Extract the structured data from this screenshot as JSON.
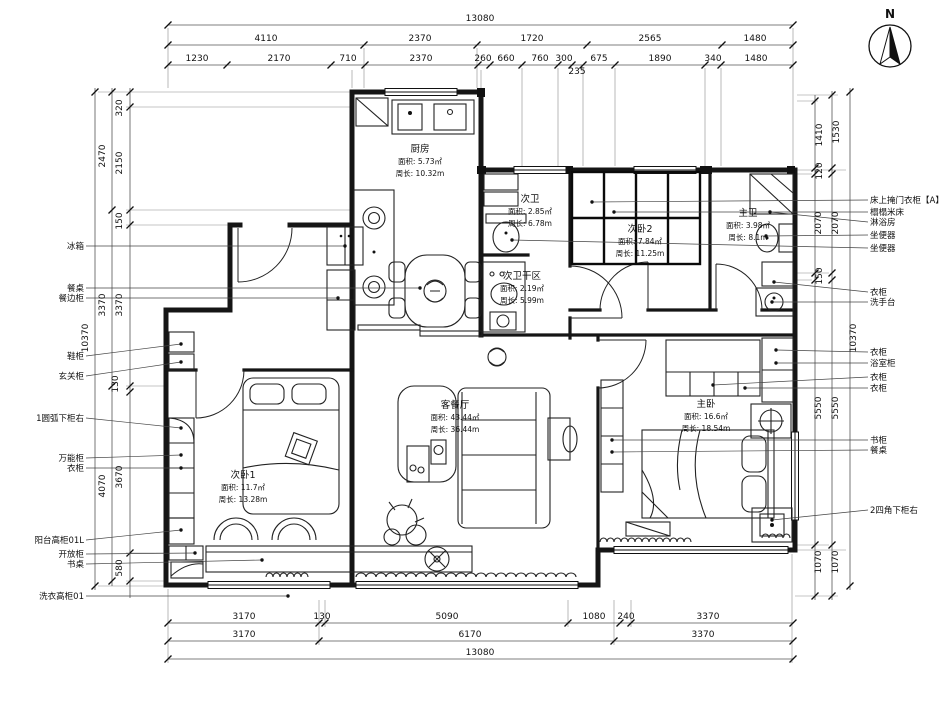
{
  "compass": {
    "label": "N"
  },
  "rooms": [
    {
      "name": "厨房",
      "area": "面积: 5.73㎡",
      "perim": "周长: 10.32m",
      "x": 420,
      "y": 152
    },
    {
      "name": "次卫",
      "area": "面积: 2.85㎡",
      "perim": "周长: 6.78m",
      "x": 530,
      "y": 202
    },
    {
      "name": "次卧2",
      "area": "面积: 7.84㎡",
      "perim": "周长: 11.25m",
      "x": 640,
      "y": 232
    },
    {
      "name": "次卫干区",
      "area": "面积: 2.19㎡",
      "perim": "周长: 5.99m",
      "x": 522,
      "y": 279
    },
    {
      "name": "主卫",
      "area": "面积: 3.98㎡",
      "perim": "周长: 8.1m",
      "x": 748,
      "y": 216
    },
    {
      "name": "客餐厅",
      "area": "面积: 43.44㎡",
      "perim": "周长: 36.44m",
      "x": 455,
      "y": 408
    },
    {
      "name": "主卧",
      "area": "面积: 16.6㎡",
      "perim": "周长: 18.54m",
      "x": 706,
      "y": 407
    },
    {
      "name": "次卧1",
      "area": "面积: 11.7㎡",
      "perim": "周长: 13.28m",
      "x": 243,
      "y": 478
    }
  ],
  "dims": [
    {
      "t": "13080",
      "x": 480,
      "y": 21
    },
    {
      "t": "4110",
      "x": 266,
      "y": 41
    },
    {
      "t": "2370",
      "x": 420,
      "y": 41
    },
    {
      "t": "1720",
      "x": 532,
      "y": 41
    },
    {
      "t": "2565",
      "x": 650,
      "y": 41
    },
    {
      "t": "1480",
      "x": 755,
      "y": 41
    },
    {
      "t": "1230",
      "x": 197,
      "y": 61
    },
    {
      "t": "2170",
      "x": 279,
      "y": 61
    },
    {
      "t": "710",
      "x": 348,
      "y": 61
    },
    {
      "t": "2370",
      "x": 421,
      "y": 61
    },
    {
      "t": "260",
      "x": 483,
      "y": 61
    },
    {
      "t": "660",
      "x": 506,
      "y": 61
    },
    {
      "t": "760",
      "x": 540,
      "y": 61
    },
    {
      "t": "300",
      "x": 564,
      "y": 61
    },
    {
      "t": "675",
      "x": 599,
      "y": 61
    },
    {
      "t": "1890",
      "x": 660,
      "y": 61
    },
    {
      "t": "340",
      "x": 713,
      "y": 61
    },
    {
      "t": "1480",
      "x": 756,
      "y": 61
    },
    {
      "t": "235",
      "x": 577,
      "y": 74
    },
    {
      "t": "3170",
      "x": 244,
      "y": 619
    },
    {
      "t": "130",
      "x": 322,
      "y": 619
    },
    {
      "t": "5090",
      "x": 447,
      "y": 619
    },
    {
      "t": "1080",
      "x": 594,
      "y": 619
    },
    {
      "t": "240",
      "x": 626,
      "y": 619
    },
    {
      "t": "3370",
      "x": 708,
      "y": 619
    },
    {
      "t": "3170",
      "x": 244,
      "y": 637
    },
    {
      "t": "6170",
      "x": 470,
      "y": 637
    },
    {
      "t": "3370",
      "x": 703,
      "y": 637
    },
    {
      "t": "13080",
      "x": 480,
      "y": 655
    },
    {
      "t": "320",
      "x": 122,
      "y": 108,
      "r": 1
    },
    {
      "t": "2470",
      "x": 105,
      "y": 156,
      "r": 1
    },
    {
      "t": "2150",
      "x": 122,
      "y": 163,
      "r": 1
    },
    {
      "t": "150",
      "x": 122,
      "y": 221,
      "r": 1
    },
    {
      "t": "3370",
      "x": 105,
      "y": 305,
      "r": 1
    },
    {
      "t": "3370",
      "x": 122,
      "y": 305,
      "r": 1
    },
    {
      "t": "10370",
      "x": 88,
      "y": 338,
      "r": 1
    },
    {
      "t": "130",
      "x": 118,
      "y": 384,
      "r": 1
    },
    {
      "t": "4070",
      "x": 105,
      "y": 486,
      "r": 1
    },
    {
      "t": "3670",
      "x": 122,
      "y": 477,
      "r": 1
    },
    {
      "t": "580",
      "x": 122,
      "y": 568,
      "r": 1
    },
    {
      "t": "1410",
      "x": 822,
      "y": 135,
      "r": 1
    },
    {
      "t": "1530",
      "x": 839,
      "y": 132,
      "r": 1
    },
    {
      "t": "120",
      "x": 822,
      "y": 171,
      "r": 1
    },
    {
      "t": "2070",
      "x": 821,
      "y": 223,
      "r": 1
    },
    {
      "t": "2070",
      "x": 838,
      "y": 223,
      "r": 1
    },
    {
      "t": "150",
      "x": 822,
      "y": 276,
      "r": 1
    },
    {
      "t": "10370",
      "x": 856,
      "y": 338,
      "r": 1
    },
    {
      "t": "5550",
      "x": 821,
      "y": 408,
      "r": 1
    },
    {
      "t": "5550",
      "x": 838,
      "y": 408,
      "r": 1
    },
    {
      "t": "1070",
      "x": 821,
      "y": 562,
      "r": 1
    },
    {
      "t": "1070",
      "x": 838,
      "y": 562,
      "r": 1
    }
  ],
  "callouts_left": [
    {
      "t": "冰箱",
      "y": 246,
      "tx": 345,
      "ty": 246
    },
    {
      "t": "餐桌",
      "y": 288,
      "tx": 420,
      "ty": 288
    },
    {
      "t": "餐边柜",
      "y": 298,
      "tx": 338,
      "ty": 298
    },
    {
      "t": "鞋柜",
      "y": 356,
      "tx": 181,
      "ty": 344
    },
    {
      "t": "玄关柜",
      "y": 376,
      "tx": 181,
      "ty": 362
    },
    {
      "t": "1圆弧下柜右",
      "y": 418,
      "tx": 181,
      "ty": 428
    },
    {
      "t": "万能柜",
      "y": 458,
      "tx": 181,
      "ty": 455
    },
    {
      "t": "衣柜",
      "y": 468,
      "tx": 181,
      "ty": 468
    },
    {
      "t": "阳台高柜01L",
      "y": 540,
      "tx": 181,
      "ty": 530
    },
    {
      "t": "开放柜",
      "y": 554,
      "tx": 195,
      "ty": 553
    },
    {
      "t": "书桌",
      "y": 564,
      "tx": 262,
      "ty": 560
    },
    {
      "t": "洗衣高柜01",
      "y": 596,
      "tx": 288,
      "ty": 596
    }
  ],
  "callouts_right": [
    {
      "t": "床上掩门衣柜【A】",
      "y": 200,
      "tx": 592,
      "ty": 202
    },
    {
      "t": "榻榻米床",
      "y": 212,
      "tx": 614,
      "ty": 212
    },
    {
      "t": "淋浴房",
      "y": 222,
      "tx": 770,
      "ty": 212
    },
    {
      "t": "坐便器",
      "y": 235,
      "tx": 766,
      "ty": 236
    },
    {
      "t": "坐便器",
      "y": 248,
      "tx": 512,
      "ty": 240
    },
    {
      "t": "衣柜",
      "y": 292,
      "tx": 774,
      "ty": 282
    },
    {
      "t": "洗手台",
      "y": 302,
      "tx": 772,
      "ty": 302
    },
    {
      "t": "衣柜",
      "y": 352,
      "tx": 776,
      "ty": 350
    },
    {
      "t": "浴室柜",
      "y": 363,
      "tx": 776,
      "ty": 363
    },
    {
      "t": "衣柜",
      "y": 377,
      "tx": 713,
      "ty": 385
    },
    {
      "t": "衣柜",
      "y": 388,
      "tx": 745,
      "ty": 388
    },
    {
      "t": "书柜",
      "y": 440,
      "tx": 612,
      "ty": 440
    },
    {
      "t": "餐桌",
      "y": 450,
      "tx": 612,
      "ty": 452
    },
    {
      "t": "2四角下柜右",
      "y": 510,
      "tx": 772,
      "ty": 520
    }
  ],
  "rails": [
    {
      "a": "h",
      "p": 25,
      "f": 168,
      "e": 793,
      "ticks": [
        168,
        793
      ]
    },
    {
      "a": "h",
      "p": 45,
      "f": 168,
      "e": 793,
      "ticks": [
        168,
        364,
        477,
        587,
        722,
        793
      ]
    },
    {
      "a": "h",
      "p": 65,
      "f": 168,
      "e": 793,
      "ticks": [
        168,
        227,
        331,
        365,
        478,
        490,
        522,
        558,
        572,
        583,
        615,
        705,
        721,
        793
      ]
    },
    {
      "a": "h",
      "p": 623,
      "f": 168,
      "e": 793,
      "ticks": [
        168,
        319,
        325,
        568,
        620,
        631,
        793
      ]
    },
    {
      "a": "h",
      "p": 641,
      "f": 168,
      "e": 793,
      "ticks": [
        168,
        319,
        614,
        793
      ]
    },
    {
      "a": "h",
      "p": 659,
      "f": 168,
      "e": 793,
      "ticks": [
        168,
        793
      ]
    },
    {
      "a": "v",
      "p": 95,
      "f": 88,
      "e": 590,
      "ticks": [
        92,
        586
      ]
    },
    {
      "a": "v",
      "p": 112,
      "f": 88,
      "e": 586,
      "ticks": [
        92,
        210,
        386,
        581
      ]
    },
    {
      "a": "v",
      "p": 130,
      "f": 88,
      "e": 598,
      "ticks": [
        92,
        107,
        210,
        225,
        386,
        392,
        553,
        581
      ]
    },
    {
      "a": "v",
      "p": 815,
      "f": 95,
      "e": 600,
      "ticks": [
        101,
        168,
        174,
        273,
        280,
        545,
        596
      ]
    },
    {
      "a": "v",
      "p": 832,
      "f": 91,
      "e": 600,
      "ticks": [
        95,
        168,
        174,
        273,
        280,
        545,
        596
      ]
    },
    {
      "a": "v",
      "p": 850,
      "f": 88,
      "e": 590,
      "ticks": [
        92,
        586
      ]
    }
  ]
}
